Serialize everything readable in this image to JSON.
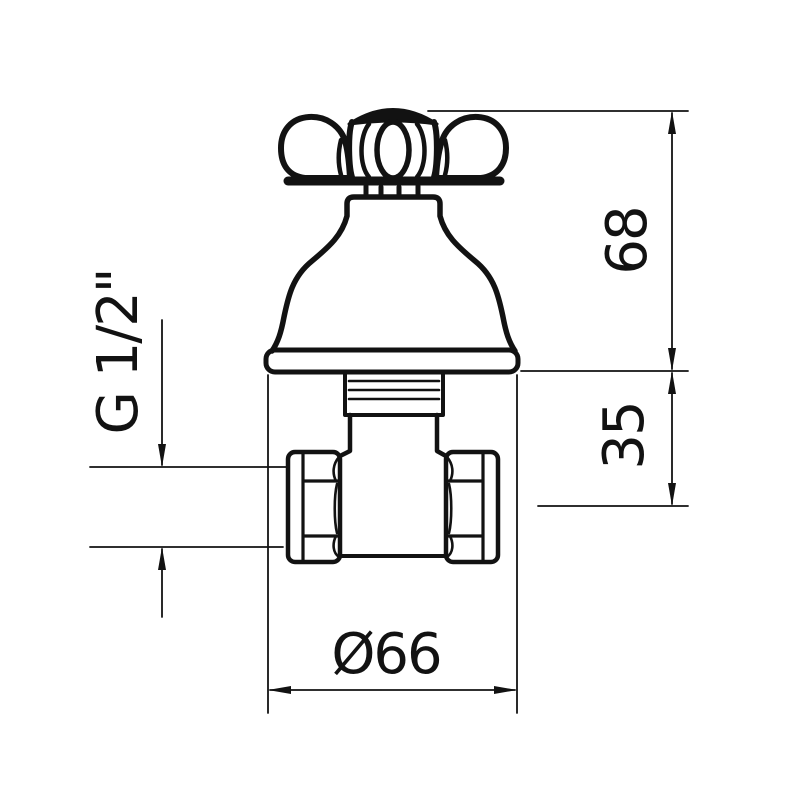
{
  "drawing": {
    "type": "technical-dimension-drawing",
    "subject": "cross-handle concealed stop valve, front view",
    "background_color": "#ffffff",
    "line_color": "#121212",
    "dimensions": {
      "total_height": "68",
      "body_depth": "35",
      "flange_diameter": "Ø66",
      "thread_size": "G 1/2\""
    }
  }
}
